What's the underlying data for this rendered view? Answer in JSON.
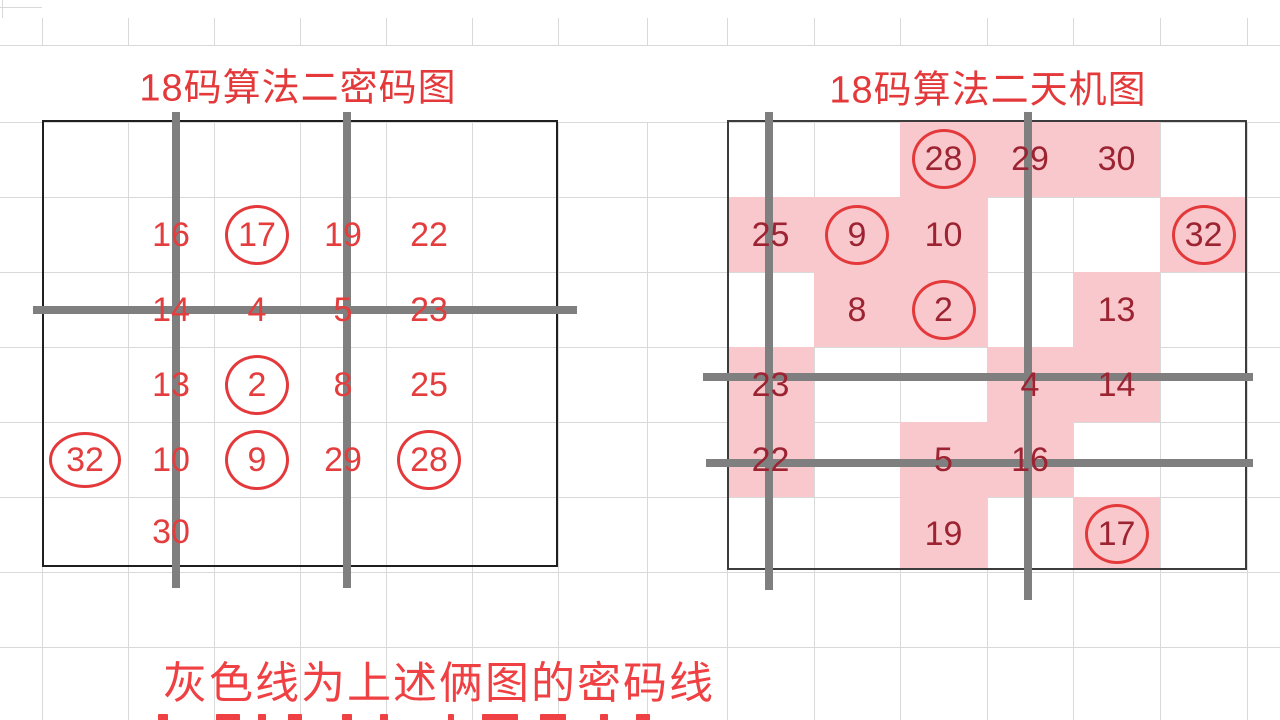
{
  "colors": {
    "bright_red": "#e4393b",
    "left_number_red": "#e43d3e",
    "right_number_red": "#9c2432",
    "pink_fill": "#f9c8cc",
    "gray_line": "#7f7f7f",
    "sheet_gridline": "#d9d9d9",
    "left_box_border": "#1f1f1f",
    "right_box_border": "#3c3c3c",
    "footer_red": "#ef4143"
  },
  "grids": {
    "left": {
      "title": "18码算法二密码图",
      "title_center": {
        "x": 298,
        "y": 84
      },
      "box": {
        "x": 42,
        "y": 120,
        "w": 516,
        "h": 447
      },
      "cols": [
        42,
        128,
        214,
        300,
        386,
        472,
        558
      ],
      "rows": [
        120,
        197,
        272,
        347,
        422,
        497,
        567
      ],
      "cells": [
        {
          "col": 1,
          "row": 1,
          "value": "16",
          "circled": false
        },
        {
          "col": 2,
          "row": 1,
          "value": "17",
          "circled": true
        },
        {
          "col": 3,
          "row": 1,
          "value": "19",
          "circled": false
        },
        {
          "col": 4,
          "row": 1,
          "value": "22",
          "circled": false
        },
        {
          "col": 1,
          "row": 2,
          "value": "14",
          "circled": false
        },
        {
          "col": 2,
          "row": 2,
          "value": "4",
          "circled": false
        },
        {
          "col": 3,
          "row": 2,
          "value": "5",
          "circled": false
        },
        {
          "col": 4,
          "row": 2,
          "value": "23",
          "circled": false
        },
        {
          "col": 1,
          "row": 3,
          "value": "13",
          "circled": false
        },
        {
          "col": 2,
          "row": 3,
          "value": "2",
          "circled": true
        },
        {
          "col": 3,
          "row": 3,
          "value": "8",
          "circled": false
        },
        {
          "col": 4,
          "row": 3,
          "value": "25",
          "circled": false
        },
        {
          "col": 0,
          "row": 4,
          "value": "32",
          "circled": true,
          "wide": true
        },
        {
          "col": 1,
          "row": 4,
          "value": "10",
          "circled": false
        },
        {
          "col": 2,
          "row": 4,
          "value": "9",
          "circled": true
        },
        {
          "col": 3,
          "row": 4,
          "value": "29",
          "circled": false
        },
        {
          "col": 4,
          "row": 4,
          "value": "28",
          "circled": true
        },
        {
          "col": 1,
          "row": 5,
          "value": "30",
          "circled": false
        }
      ],
      "gray_lines": [
        {
          "type": "v",
          "pos": 176,
          "from": 112,
          "to": 588
        },
        {
          "type": "v",
          "pos": 347,
          "from": 112,
          "to": 588
        },
        {
          "type": "h",
          "pos": 310,
          "from": 33,
          "to": 577
        }
      ]
    },
    "right": {
      "title": "18码算法二天机图",
      "title_center": {
        "x": 988,
        "y": 86
      },
      "box": {
        "x": 727,
        "y": 120,
        "w": 520,
        "h": 450
      },
      "cols": [
        727,
        814,
        900,
        987,
        1073,
        1160,
        1247
      ],
      "rows": [
        120,
        197,
        272,
        347,
        422,
        497,
        570
      ],
      "cells": [
        {
          "col": 2,
          "row": 0,
          "value": "28",
          "circled": true
        },
        {
          "col": 3,
          "row": 0,
          "value": "29",
          "circled": false
        },
        {
          "col": 4,
          "row": 0,
          "value": "30",
          "circled": false
        },
        {
          "col": 0,
          "row": 1,
          "value": "25",
          "circled": false
        },
        {
          "col": 1,
          "row": 1,
          "value": "9",
          "circled": true
        },
        {
          "col": 2,
          "row": 1,
          "value": "10",
          "circled": false
        },
        {
          "col": 5,
          "row": 1,
          "value": "32",
          "circled": true
        },
        {
          "col": 1,
          "row": 2,
          "value": "8",
          "circled": false
        },
        {
          "col": 2,
          "row": 2,
          "value": "2",
          "circled": true
        },
        {
          "col": 4,
          "row": 2,
          "value": "13",
          "circled": false
        },
        {
          "col": 0,
          "row": 3,
          "value": "23",
          "circled": false
        },
        {
          "col": 3,
          "row": 3,
          "value": "4",
          "circled": false
        },
        {
          "col": 4,
          "row": 3,
          "value": "14",
          "circled": false
        },
        {
          "col": 0,
          "row": 4,
          "value": "22",
          "circled": false
        },
        {
          "col": 2,
          "row": 4,
          "value": "5",
          "circled": false
        },
        {
          "col": 3,
          "row": 4,
          "value": "16",
          "circled": false
        },
        {
          "col": 2,
          "row": 5,
          "value": "19",
          "circled": false
        },
        {
          "col": 4,
          "row": 5,
          "value": "17",
          "circled": true
        }
      ],
      "pink_cells": [
        {
          "col": 2,
          "row": 0
        },
        {
          "col": 3,
          "row": 0
        },
        {
          "col": 4,
          "row": 0
        },
        {
          "col": 0,
          "row": 1
        },
        {
          "col": 1,
          "row": 1
        },
        {
          "col": 2,
          "row": 1
        },
        {
          "col": 5,
          "row": 1
        },
        {
          "col": 1,
          "row": 2
        },
        {
          "col": 2,
          "row": 2
        },
        {
          "col": 4,
          "row": 2
        },
        {
          "col": 0,
          "row": 3
        },
        {
          "col": 3,
          "row": 3
        },
        {
          "col": 4,
          "row": 3
        },
        {
          "col": 0,
          "row": 4
        },
        {
          "col": 2,
          "row": 4
        },
        {
          "col": 3,
          "row": 4
        },
        {
          "col": 2,
          "row": 5
        },
        {
          "col": 4,
          "row": 5
        }
      ],
      "gray_lines": [
        {
          "type": "v",
          "pos": 769,
          "from": 112,
          "to": 590
        },
        {
          "type": "v",
          "pos": 1028,
          "from": 112,
          "to": 600
        },
        {
          "type": "h",
          "pos": 377,
          "from": 703,
          "to": 1253
        },
        {
          "type": "h",
          "pos": 463,
          "from": 706,
          "to": 1253
        }
      ]
    }
  },
  "footer": {
    "line1": "灰色线为上述俩图的密码线",
    "line1_pos": {
      "x": 163,
      "y": 679
    },
    "clipped_line_fragments": [
      {
        "x": 158,
        "w": 10
      },
      {
        "x": 216,
        "w": 24
      },
      {
        "x": 258,
        "w": 8
      },
      {
        "x": 288,
        "w": 14
      },
      {
        "x": 342,
        "w": 10
      },
      {
        "x": 380,
        "w": 8
      },
      {
        "x": 448,
        "w": 6
      },
      {
        "x": 482,
        "w": 36
      },
      {
        "x": 540,
        "w": 26
      },
      {
        "x": 600,
        "w": 8
      },
      {
        "x": 636,
        "w": 14
      }
    ]
  }
}
